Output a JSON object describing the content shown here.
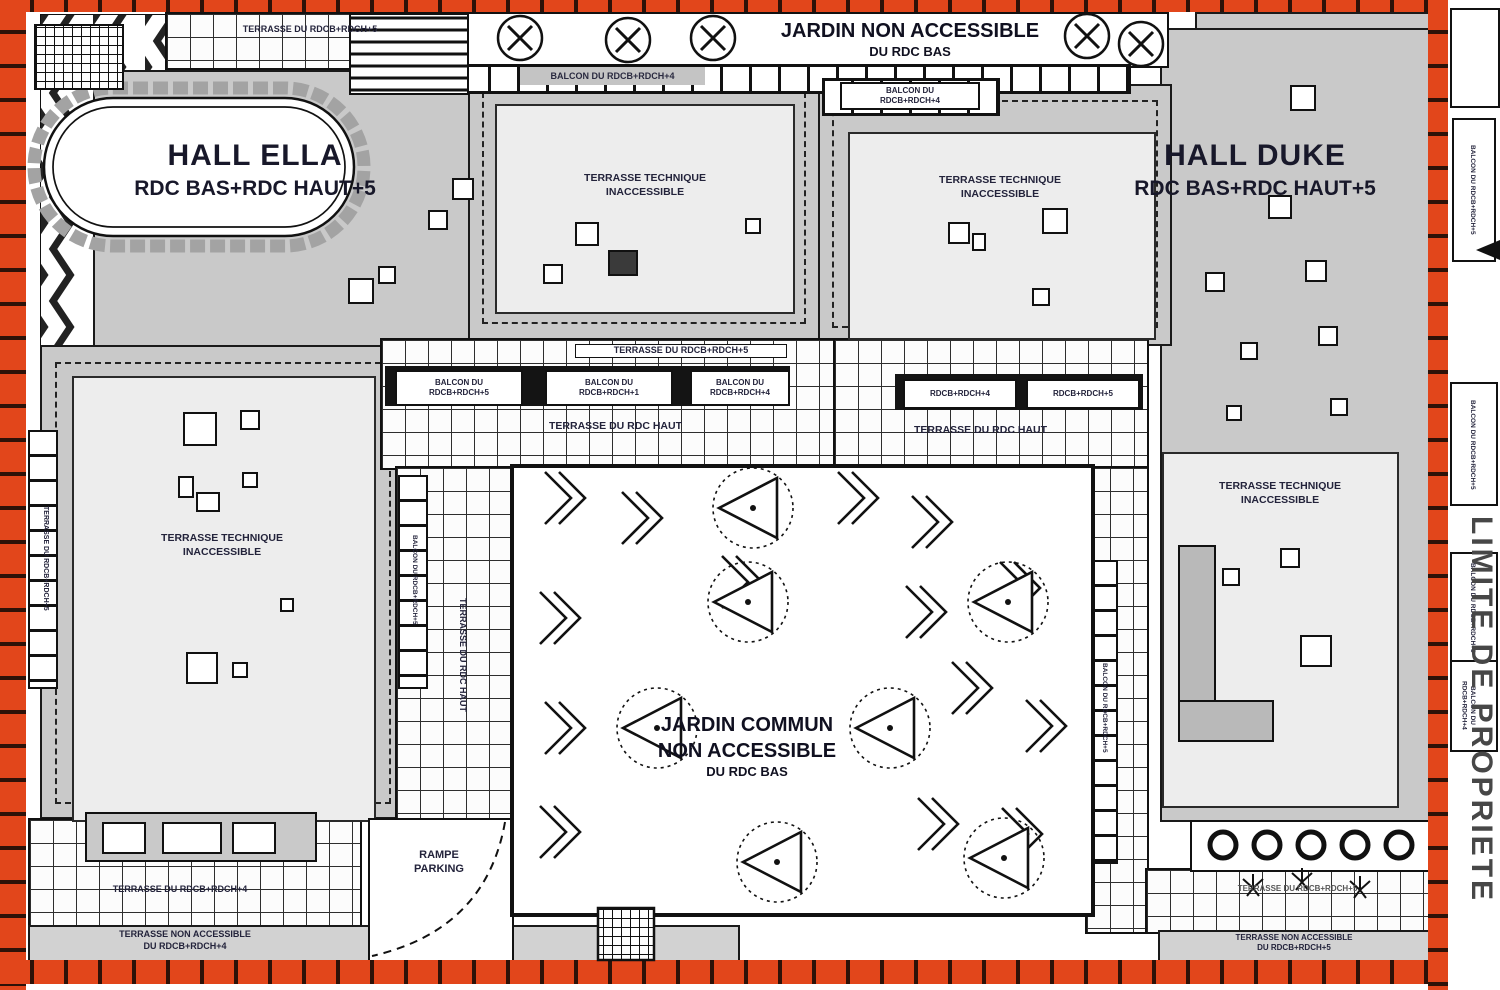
{
  "plan": {
    "colors": {
      "property_hatch": "#e2461b",
      "building_grey": "#c9c9c9",
      "terrace_light": "#ededed",
      "label_ink": "#23233b"
    },
    "halls": {
      "ella": {
        "name": "HALL ELLA",
        "levels": "RDC BAS+RDC HAUT+5"
      },
      "duke": {
        "name": "HALL DUKE",
        "levels": "RDC BAS+RDC HAUT+5"
      }
    },
    "garden_north": {
      "line1": "JARDIN NON ACCESSIBLE",
      "line2": "DU RDC BAS"
    },
    "garden_central": {
      "line1": "JARDIN COMMUN",
      "line2": "NON ACCESSIBLE",
      "line3": "DU RDC BAS"
    },
    "ttech": {
      "line1": "TERRASSE TECHNIQUE",
      "line2": "INACCESSIBLE"
    },
    "terraces": {
      "top_band": "TERRASSE DU RDCB+RDCH+5",
      "mid_band": "TERRASSE DU RDCB+RDCH+5",
      "rdc_haut": "TERRASSE DU RDC HAUT",
      "bottom_left": "TERRASSE DU RDCB+RDCH+4",
      "bottom_right": "TERRASSE DU RDCB+RDCH+5",
      "left_edge": "TERRASSE DU RDCB+RDCH+5"
    },
    "nonacc": {
      "left": {
        "line1": "TERRASSE NON ACCESSIBLE",
        "line2": "DU RDCB+RDCH+4"
      },
      "right": {
        "line1": "TERRASSE NON ACCESSIBLE",
        "line2": "DU RDCB+RDCH+5"
      }
    },
    "balconies": {
      "top_band": "BALCON DU RDCB+RDCH+4",
      "top_small": {
        "line1": "BALCON DU",
        "line2": "RDCB+RDCH+4"
      },
      "row_left": [
        {
          "line1": "BALCON DU",
          "line2": "RDCB+RDCH+5"
        },
        {
          "line1": "BALCON DU",
          "line2": "RDCB+RDCH+1"
        },
        {
          "line1": "BALCON DU",
          "line2": "RDCB+RDCH+4"
        }
      ],
      "row_right": [
        "RDCB+RDCH+4",
        "RDCB+RDCH+5"
      ],
      "vert_left": "BALCON DU RDCB+RDCH+5",
      "vert_right": "BALCON DU RDCB+RDCH+5",
      "right_edge": [
        "BALCON DU RDCB+RDCH+5",
        "BALCON DU RDCB+RDCH+5",
        "BALCON DU RDCB+RDCH+5",
        "BALCON DU RDCB+RDCH+4"
      ]
    },
    "parking": {
      "line1": "RAMPE",
      "line2": "PARKING"
    },
    "property_line": "LIMITE DE PROPRIETE"
  }
}
